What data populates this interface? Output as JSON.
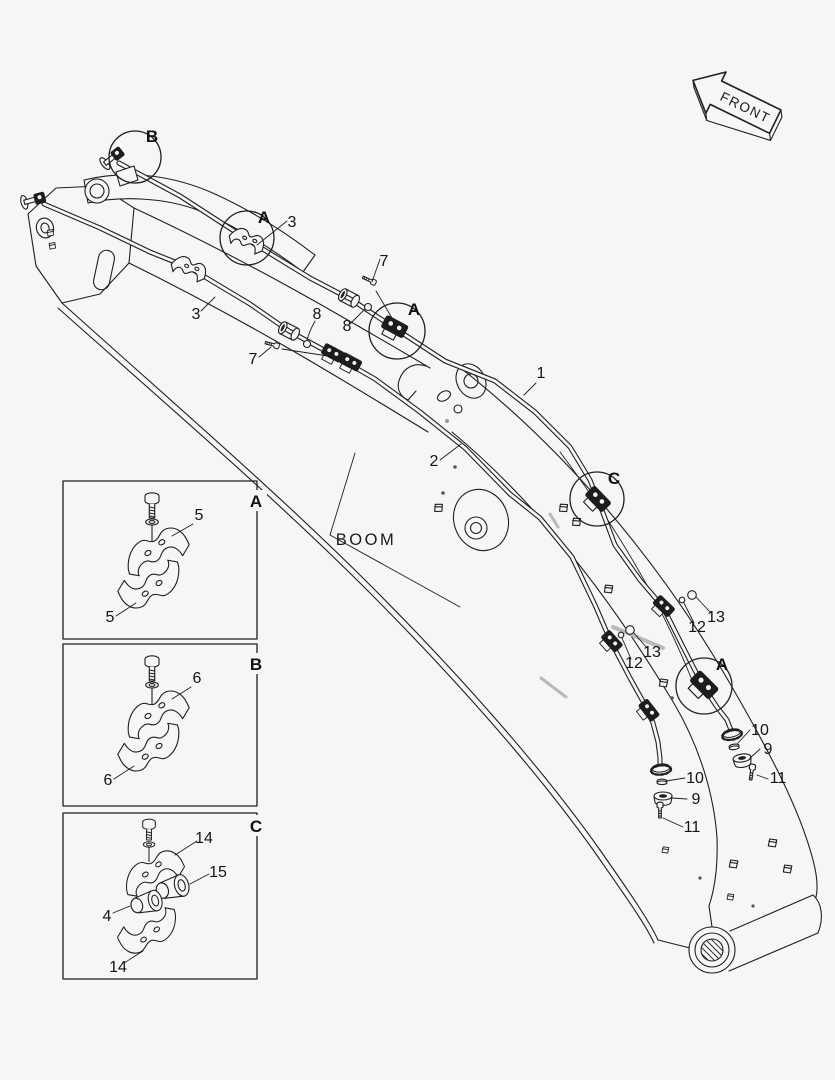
{
  "colors": {
    "background": "#f6f6f4",
    "line": "#1f1f1f",
    "gray_seam": "#b9b9b9"
  },
  "labels": {
    "front": "FRONT",
    "boom": "BOOM",
    "markers": {
      "b": "B",
      "a1": "A",
      "a2": "A",
      "c": "C",
      "a3": "A"
    },
    "callouts": {
      "n1": "1",
      "n2": "2",
      "n3a": "3",
      "n3b": "3",
      "n7a": "7",
      "n7b": "7",
      "n8a": "8",
      "n8b": "8",
      "n9a": "9",
      "n9b": "9",
      "n10a": "10",
      "n10b": "10",
      "n11a": "11",
      "n11b": "11",
      "n12a": "12",
      "n12b": "12",
      "n13a": "13",
      "n13b": "13"
    },
    "boxes": [
      {
        "letter": "A",
        "part_top": "5",
        "part_bottom": "5"
      },
      {
        "letter": "B",
        "part_top": "6",
        "part_bottom": "6"
      },
      {
        "letter": "C",
        "part_top": "14",
        "part_mid": "15",
        "part_low": "4",
        "part_bottom": "14"
      }
    ]
  }
}
